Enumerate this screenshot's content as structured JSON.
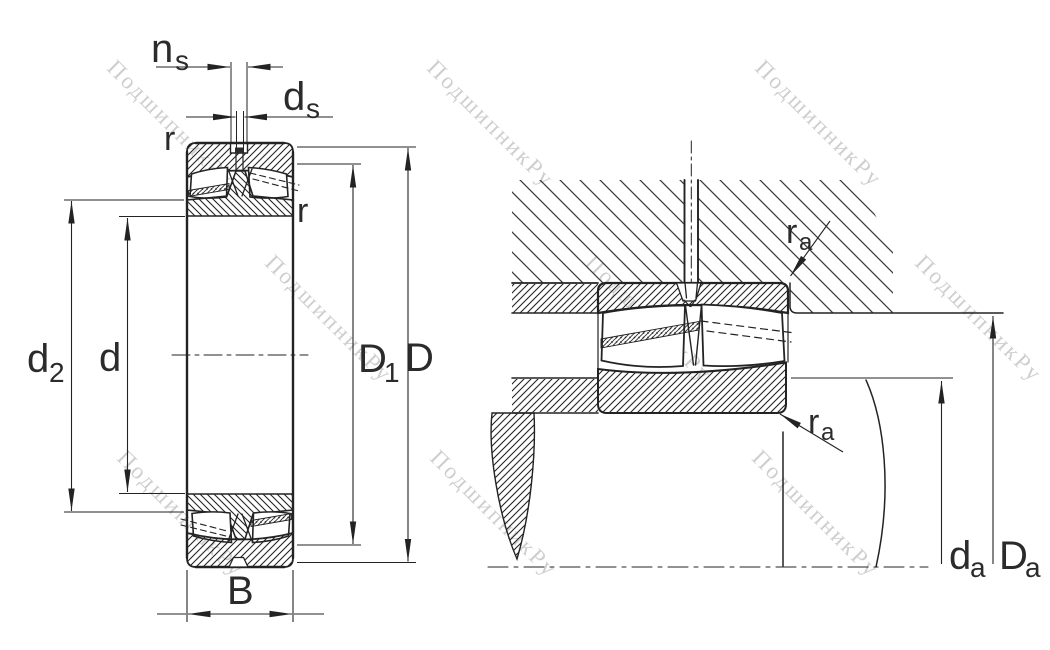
{
  "watermark": {
    "text": "ПодшипникРу",
    "color": "#c9c9c9"
  },
  "colors": {
    "background": "#ffffff",
    "drawing_line": "#232323",
    "label_text": "#2b2b2b",
    "housing_hatch": "#3c3c3c",
    "watermark": "#c9c9c9"
  },
  "left_view": {
    "description": "bearing cross-section",
    "labels": {
      "ns": {
        "main": "n",
        "sub": "s"
      },
      "ds": {
        "main": "d",
        "sub": "s"
      },
      "r_outer_ring": "r",
      "r_inner_ring": "r",
      "d2": {
        "main": "d",
        "sub": "2"
      },
      "d": "d",
      "D1": {
        "main": "D",
        "sub": "1"
      },
      "D": "D",
      "B": "B"
    }
  },
  "right_view": {
    "description": "mounting abutment section",
    "labels": {
      "ra_housing": {
        "main": "r",
        "sub": "a"
      },
      "ra_shaft": {
        "main": "r",
        "sub": "a"
      },
      "da": {
        "main": "d",
        "sub": "a"
      },
      "Da": {
        "main": "D",
        "sub": "a"
      }
    }
  }
}
